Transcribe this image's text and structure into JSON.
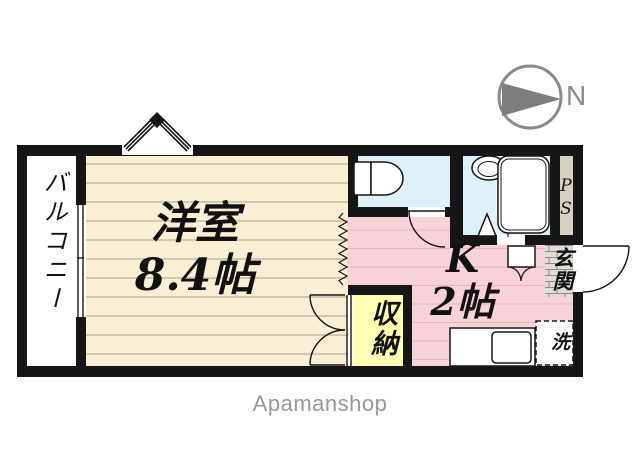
{
  "brand": {
    "watermark": "Apamanshop"
  },
  "compass": {
    "north_label": "N"
  },
  "rooms": {
    "balcony": {
      "label": "バルコニー"
    },
    "western_room": {
      "name": "洋室",
      "size": "8.4帖"
    },
    "kitchen": {
      "name": "K",
      "size": "2帖"
    },
    "storage": {
      "label": "収納"
    },
    "entrance": {
      "label": "玄関"
    },
    "pipe_space": {
      "label": "PS"
    },
    "washer": {
      "label": "洗"
    }
  },
  "colors": {
    "wall": "#161616",
    "western_room_floor": "#f9efd5",
    "western_room_line": "#b9ae94",
    "kitchen_floor": "#f8d2d9",
    "kitchen_line": "#e7b4c0",
    "wet_area_floor": "#def0f8",
    "storage_floor": "#feffb0",
    "pipe_space_fill": "#d5d1c2",
    "entrance_tile": "#dfddd5",
    "compass_gray": "#7d7d7d",
    "watermark_gray": "#96989a"
  }
}
